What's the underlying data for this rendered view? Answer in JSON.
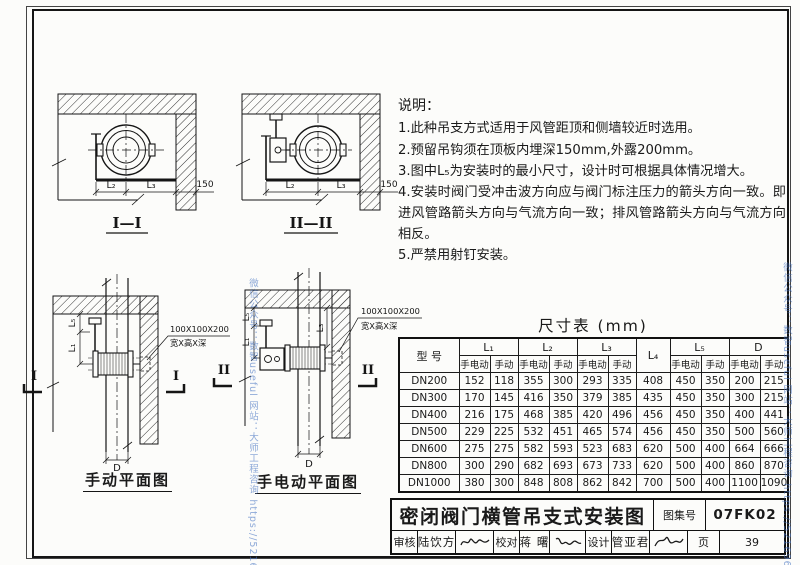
{
  "watermark": {
    "text": "微信公众号：数智useful  网站：大师工程咨询  https://521696.xyz/",
    "color": "#5b8fd4"
  },
  "notes": {
    "heading": "说明：",
    "items": [
      "1.此种吊支方式适用于风管距顶和侧墙较近时选用。",
      "2.预留吊钩须在顶板内埋深150mm,外露200mm。",
      "3.图中L₅为安装时的最小尺寸，设计时可根据具体情况增大。",
      "4.安装时阀门受冲击波方向应与阀门标注压力的箭头方向一致。即进风管路箭头方向与气流方向一致；排风管路箭头方向与气流方向相反。",
      "5.严禁用射钉安装。"
    ]
  },
  "sections": {
    "s1": {
      "label": "I—I",
      "dim_l2": "L₂",
      "dim_l3": "L₃",
      "dim_150": "150"
    },
    "s2": {
      "label": "II—II",
      "dim_l2": "L₂",
      "dim_l3": "L₃",
      "dim_150": "150"
    }
  },
  "plans": {
    "p1": {
      "label": "手动平面图",
      "marker": "I",
      "dim_l5": "L₅",
      "dim_l1": "L₁",
      "dim_d": "D",
      "callout_line1": "100X100X200",
      "callout_line2": "宽X高X深"
    },
    "p2": {
      "label": "手电动平面图",
      "marker": "II",
      "dim_l5": "L₅",
      "dim_l1": "L₁",
      "dim_l3": "L₃",
      "dim_d": "D",
      "callout_line1": "100X100X200",
      "callout_line2": "宽X高X深"
    }
  },
  "dimension_table": {
    "title": "尺寸表 (mm)",
    "model_header": "型 号",
    "group_headers": [
      "L₁",
      "L₂",
      "L₃",
      "L₄",
      "L₅",
      "D"
    ],
    "sub_electric": "手电动",
    "sub_manual": "手动",
    "rows": [
      {
        "model": "DN200",
        "values": [
          152,
          118,
          355,
          300,
          293,
          335,
          408,
          450,
          350,
          200,
          215
        ]
      },
      {
        "model": "DN300",
        "values": [
          170,
          145,
          416,
          350,
          379,
          385,
          435,
          450,
          350,
          300,
          215
        ]
      },
      {
        "model": "DN400",
        "values": [
          216,
          175,
          468,
          385,
          420,
          496,
          456,
          450,
          350,
          400,
          441
        ]
      },
      {
        "model": "DN500",
        "values": [
          229,
          225,
          532,
          451,
          465,
          574,
          456,
          450,
          350,
          500,
          560
        ]
      },
      {
        "model": "DN600",
        "values": [
          275,
          275,
          582,
          593,
          523,
          683,
          620,
          500,
          400,
          664,
          666
        ]
      },
      {
        "model": "DN800",
        "values": [
          300,
          290,
          682,
          693,
          673,
          733,
          620,
          500,
          400,
          860,
          870
        ]
      },
      {
        "model": "DN1000",
        "values": [
          380,
          300,
          848,
          808,
          862,
          842,
          700,
          500,
          400,
          1100,
          1090
        ]
      }
    ]
  },
  "titleblock": {
    "title": "密闭阀门横管吊支式安装图",
    "atlas_label": "图集号",
    "atlas_no": "07FK02",
    "page_label": "页",
    "page_no": "39",
    "review_label": "审核",
    "review_name": "陆饮方",
    "check_label": "校对",
    "check_name": "蒋 曙",
    "design_label": "设计",
    "design_name": "管亚君"
  }
}
